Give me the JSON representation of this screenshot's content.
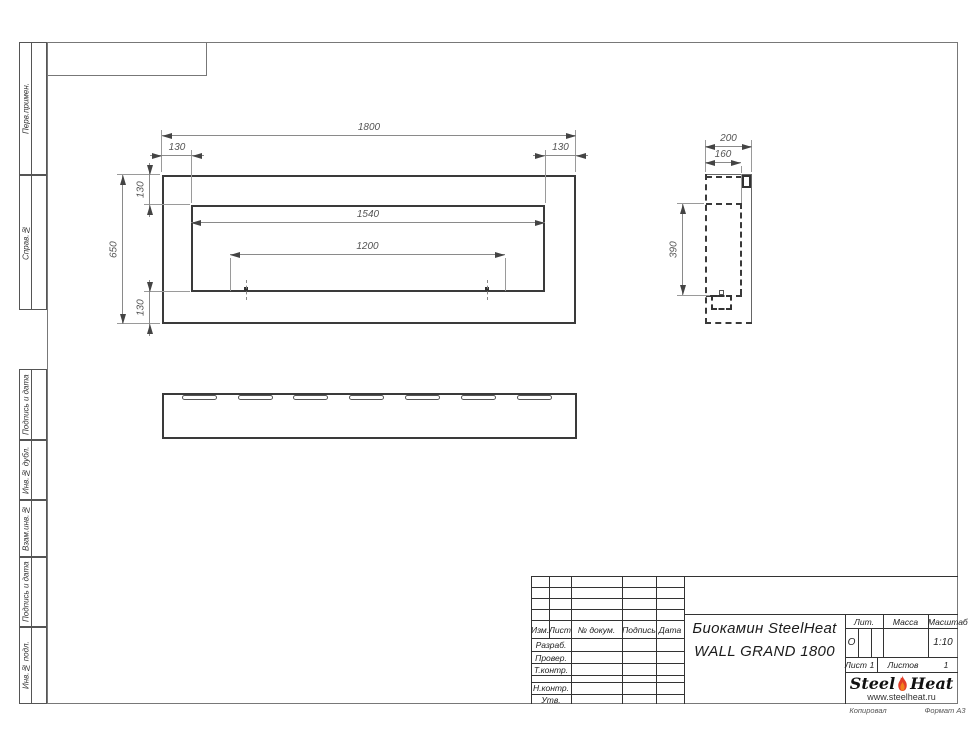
{
  "margin_labels": [
    "Перв.примен.",
    "Справ.№",
    "Подпись и дата",
    "Инв.№ дубл.",
    "Взам.инв.№",
    "Подпись и дата",
    "Инв.№ подл."
  ],
  "views": {
    "front": {
      "width": "1800",
      "offset_left": "130",
      "offset_right": "130",
      "height": "650",
      "offset_top": "130",
      "offset_bottom": "130",
      "opening_width": "1540",
      "burner_width": "1200"
    },
    "side": {
      "depth": "200",
      "inner_depth": "160",
      "inner_height": "390"
    }
  },
  "title_block": {
    "rev_cols": {
      "izm": "Изм.",
      "list": "Лист",
      "doc": "№ докум.",
      "sign": "Подпись",
      "date": "Дата"
    },
    "roles": {
      "razrab": "Разраб.",
      "prover": "Провер.",
      "tkontr": "Т.контр.",
      "nkontr": "Н.контр.",
      "utv": "Утв."
    },
    "title_line1": "Биокамин SteelHeat",
    "title_line2": "WALL GRAND 1800",
    "lit_label": "Лит.",
    "lit_value": "О",
    "mass_label": "Масса",
    "scale_label": "Масштаб",
    "scale_value": "1:10",
    "sheet_label": "Лист",
    "sheet_value": "1",
    "sheets_label": "Листов",
    "sheets_value": "1",
    "logo": {
      "steel": "Steel",
      "heat": "Heat",
      "url": "www.steelheat.ru"
    },
    "footer": {
      "kopiroval": "Копировал",
      "format": "Формат А3"
    }
  }
}
